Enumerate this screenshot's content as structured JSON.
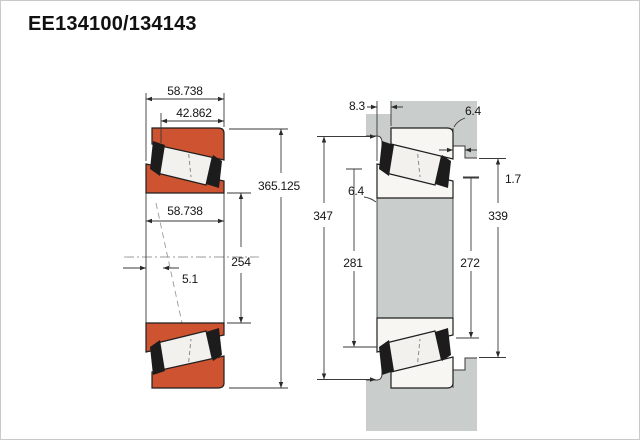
{
  "title": "EE134100/134143",
  "colors": {
    "ring_orange": "#ce5431",
    "steel_gray": "#c9cdcc",
    "roller_white": "#f3f1ee",
    "cage_black": "#1c1c1c",
    "line": "#3a3a3a"
  },
  "left_view": {
    "name": "bearing-cross-section",
    "dim_cup_width_outer": "58.738",
    "dim_cup_width_inner": "42.862",
    "dim_outer_diameter": "365.125",
    "dim_cone_width": "58.738",
    "dim_bore_diameter": "254",
    "dim_center_offset": "5.1"
  },
  "right_view": {
    "name": "mounting-fitting-section",
    "dim_front_gap": "8.3",
    "dim_cup_corner_radius": "6.4",
    "dim_cone_corner_radius": "6.4",
    "dim_backing_clearance": "1.7",
    "dim_housing_shoulder": "347",
    "dim_cup_backing": "339",
    "dim_shaft_shoulder": "281",
    "dim_cone_backing": "272"
  }
}
